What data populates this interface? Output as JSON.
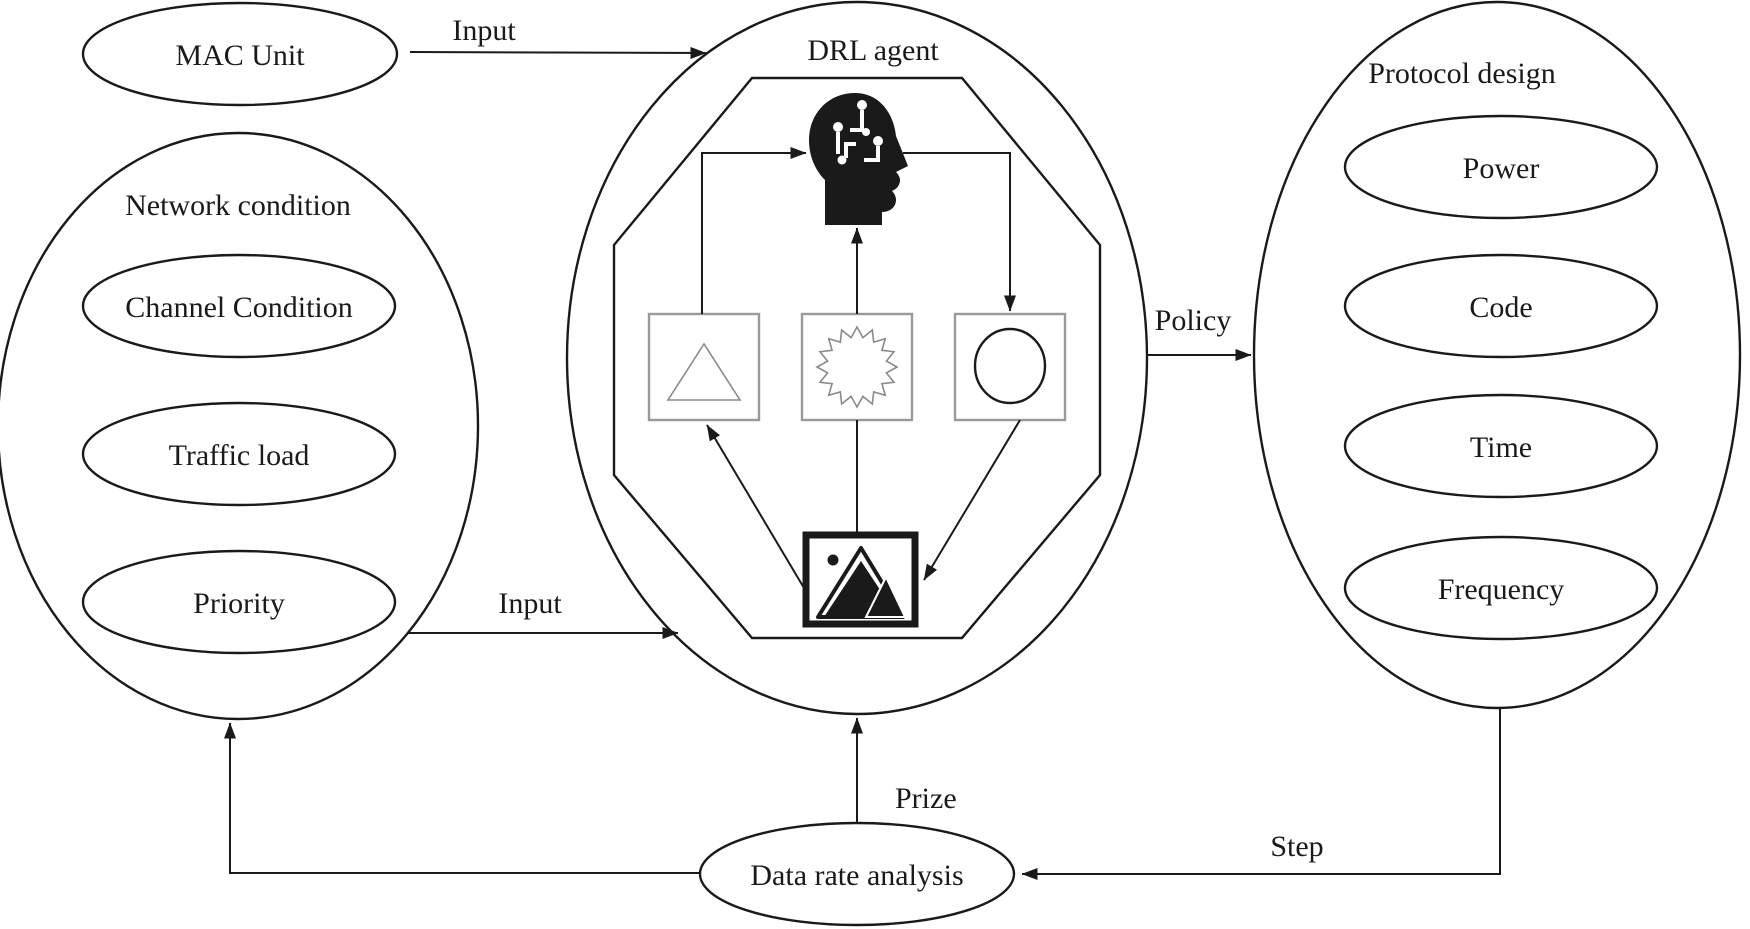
{
  "diagram": {
    "title_implicit": "DRL based protocol design loop",
    "mac_unit": {
      "label": "MAC Unit"
    },
    "network_condition": {
      "label": "Network condition",
      "items": [
        {
          "label": "Channel Condition"
        },
        {
          "label": "Traffic load"
        },
        {
          "label": "Priority"
        }
      ]
    },
    "drl_agent": {
      "label": "DRL agent",
      "icons": [
        {
          "name": "ai-head-circuit"
        },
        {
          "name": "triangle-state"
        },
        {
          "name": "starburst-reward"
        },
        {
          "name": "circle-action"
        },
        {
          "name": "environment-image"
        }
      ]
    },
    "protocol_design": {
      "label": "Protocol design",
      "items": [
        {
          "label": "Power"
        },
        {
          "label": "Code"
        },
        {
          "label": "Time"
        },
        {
          "label": "Frequency"
        }
      ]
    },
    "data_rate": {
      "label": "Data rate analysis"
    },
    "arrows": {
      "input_top": "Input",
      "input_bottom": "Input",
      "policy": "Policy",
      "prize": "Prize",
      "step": "Step"
    },
    "colors": {
      "line": "#1a1a1a",
      "box_border": "#9a9a9a",
      "fill": "#ffffff"
    }
  }
}
